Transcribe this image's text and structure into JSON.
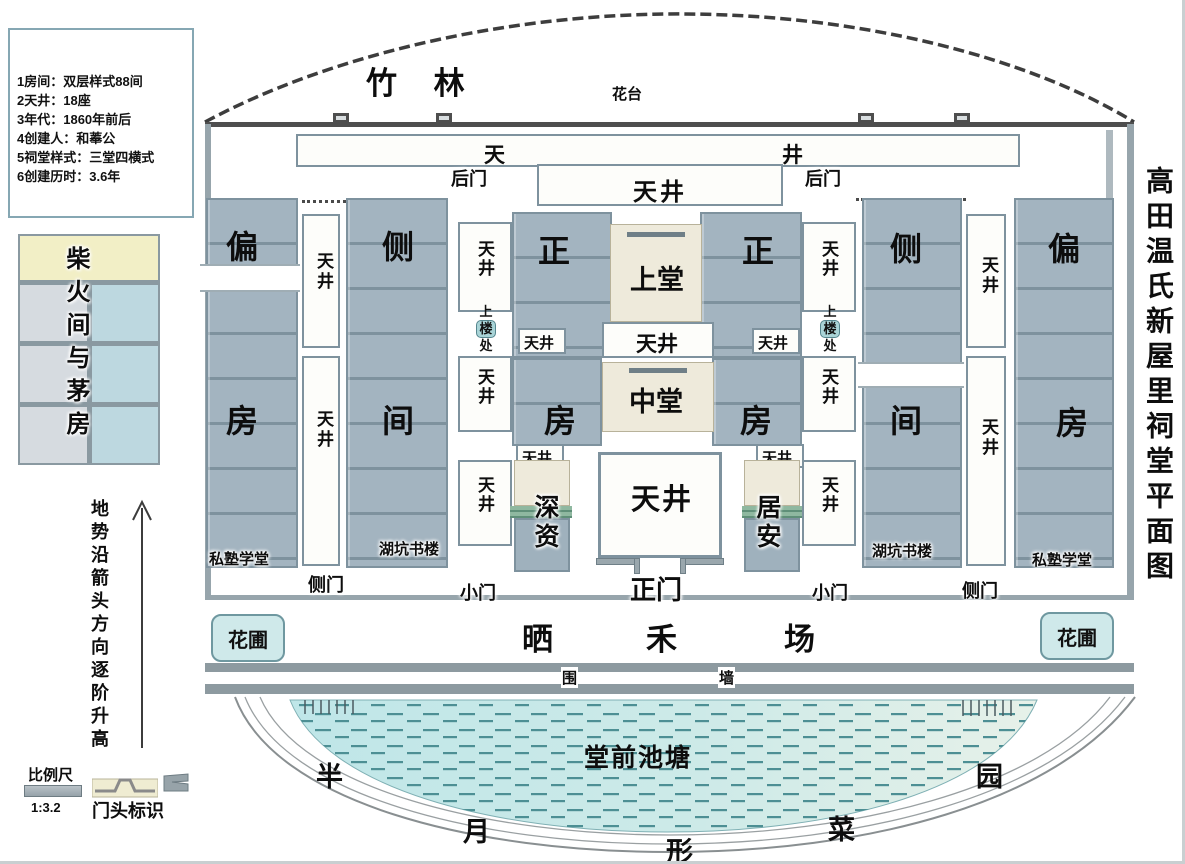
{
  "side_title": "高田温氏新屋里祠堂平面图",
  "info_box": {
    "lines": [
      "1房间：双层样式88间",
      "2天井：18座",
      "3年代：1860年前后",
      "4创建人：和菶公",
      "5祠堂样式：三堂四横式",
      "6创建历时：3.6年"
    ]
  },
  "legend": {
    "firewood_label": "柴火间与茅房",
    "terrain_note": "地势沿箭头方向逐阶升高",
    "scale_label": "比例尺",
    "scale_value": "1:3.2",
    "door_mark_label": "门头标识"
  },
  "exterior": {
    "bamboo": "竹 林",
    "flower_terrace": "花台",
    "drying_yard_chars": [
      "晒",
      "禾",
      "场"
    ],
    "flower_bed": "花圃",
    "wall_chars": [
      "围",
      "墙"
    ],
    "pond": "堂前池塘",
    "crescent_chars": [
      "半",
      "月",
      "形",
      "菜",
      "园"
    ]
  },
  "plan": {
    "tian": "天",
    "jing": "井",
    "tianjing": "天井",
    "back_door": "后门",
    "upper_hall": "上堂",
    "middle_hall": "中堂",
    "main_gate": "正门",
    "small_gate": "小门",
    "side_gate": "侧门",
    "zheng": "正",
    "fang": "房",
    "pian": "偏",
    "ce": "侧",
    "jian": "间",
    "upstairs_chars": [
      "上",
      "楼",
      "处"
    ],
    "shen_zi": "深资",
    "ju_an": "居安",
    "school": "私塾学堂",
    "book_house": "湖坑书楼"
  },
  "colors": {
    "room_fill": "#a3b4c0",
    "room_line": "#7e929e",
    "hall_fill": "#eeeadb",
    "water_fill": "#c2e7e8",
    "teal_chip": "#a9d4d7",
    "flowerbed_fill": "#cfe9ea",
    "wall_gray": "#8d9aa0",
    "firewood_header": "#f2efc6"
  }
}
